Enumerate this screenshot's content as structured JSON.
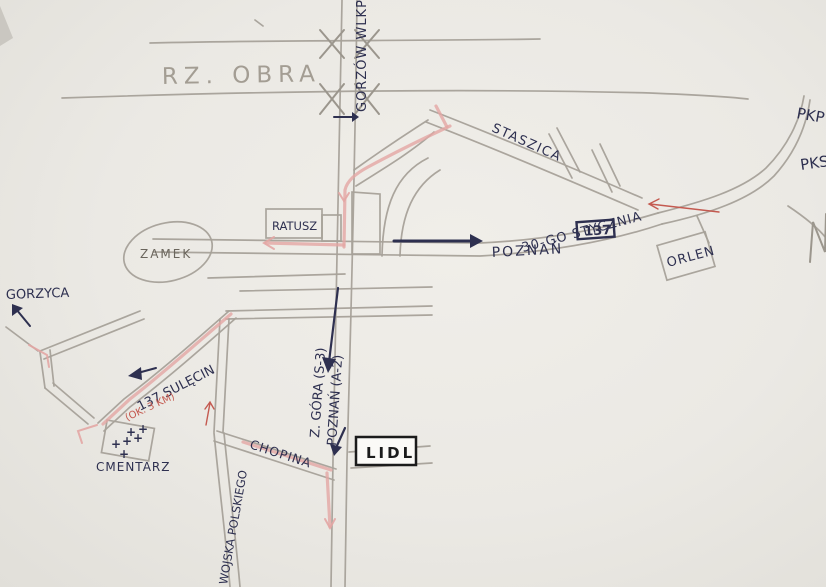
{
  "map": {
    "type": "hand-drawn-street-sketch",
    "labels": {
      "river": "RZ. OBRA",
      "road_north": "GORZÓW WLKP",
      "street_staszica": "STASZICA",
      "street_stycznia": "30-GO STYCZNIA",
      "dest_poznan": "POZNAŃ",
      "route_number": "137",
      "landmark_ratusz": "RATUSZ",
      "landmark_zamek": "ZAMEK",
      "landmark_orlen": "ORLEN",
      "station_pkp": "PKP",
      "station_pks": "PKS",
      "dest_gorzyca": "GORZYCA",
      "dest_sulecin": "137 SULĘCIN",
      "distance_note": "(OK. 3 KM)",
      "landmark_cmentarz": "CMENTARZ",
      "street_chopina": "CHOPINA",
      "street_wojska": "WOJSKA POLSKIEGO",
      "dest_zgora": "Z. GÓRA (S-3)",
      "dest_poznan_a2": "POZNAŃ (A-2)",
      "landmark_lidl": "LIDL"
    },
    "icons": {
      "grave_cross": "+"
    },
    "colors": {
      "paper": "#ebe9e4",
      "pencil": "#a7a199",
      "ink_navy": "#2e3050",
      "red_note": "#c45a50",
      "route_highlight": "#e3a6a4",
      "lidl_black": "#1b1b1b"
    }
  }
}
